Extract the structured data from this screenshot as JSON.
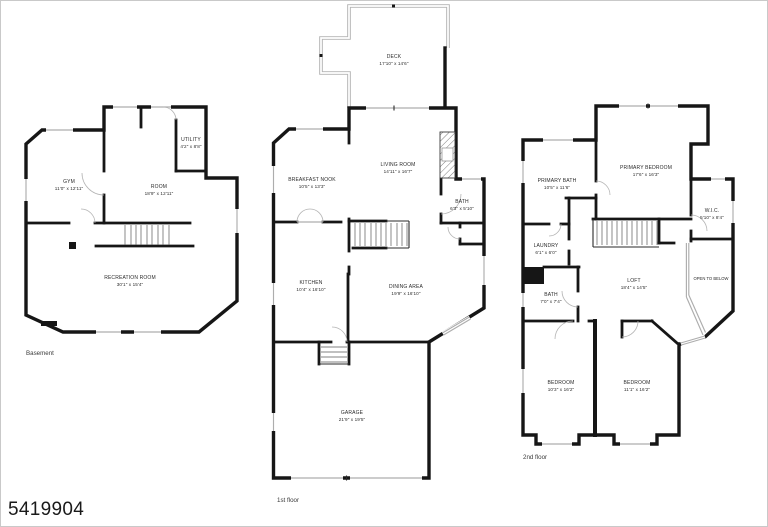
{
  "photo_id": "5419904",
  "floors": [
    {
      "label": "Basement",
      "rooms": [
        {
          "name": "GYM",
          "dims": "11'0\" x 12'11\""
        },
        {
          "name": "ROOM",
          "dims": "18'9\" x 12'11\""
        },
        {
          "name": "UTILITY",
          "dims": "4'2\" x 8'8\""
        },
        {
          "name": "RECREATION ROOM",
          "dims": "30'1\" x 15'4\""
        }
      ]
    },
    {
      "label": "1st floor",
      "rooms": [
        {
          "name": "DECK",
          "dims": "17'10\" x 14'6\""
        },
        {
          "name": "BREAKFAST NOOK",
          "dims": "10'5\" x 13'3\""
        },
        {
          "name": "LIVING ROOM",
          "dims": "14'11\" x 16'7\""
        },
        {
          "name": "BATH",
          "dims": "6'3\" x 5'10\""
        },
        {
          "name": "KITCHEN",
          "dims": "10'4\" x 16'10\""
        },
        {
          "name": "DINING AREA",
          "dims": "19'9\" x 16'10\""
        },
        {
          "name": "GARAGE",
          "dims": "21'9\" x 19'5\""
        }
      ]
    },
    {
      "label": "2nd floor",
      "rooms": [
        {
          "name": "PRIMARY BATH",
          "dims": "10'5\" x 11'6\""
        },
        {
          "name": "PRIMARY BEDROOM",
          "dims": "17'6\" x 16'3\""
        },
        {
          "name": "W.I.C.",
          "dims": "5'10\" x 8'4\""
        },
        {
          "name": "LAUNDRY",
          "dims": "6'1\" x 6'0\""
        },
        {
          "name": "BATH",
          "dims": "7'0\" x 7'4\""
        },
        {
          "name": "LOFT",
          "dims": "18'4\" x 14'5\""
        },
        {
          "name": "OPEN TO BELOW",
          "dims": ""
        },
        {
          "name": "BEDROOM",
          "dims": "10'3\" x 16'2\""
        },
        {
          "name": "BEDROOM",
          "dims": "11'1\" x 16'2\""
        }
      ]
    }
  ]
}
